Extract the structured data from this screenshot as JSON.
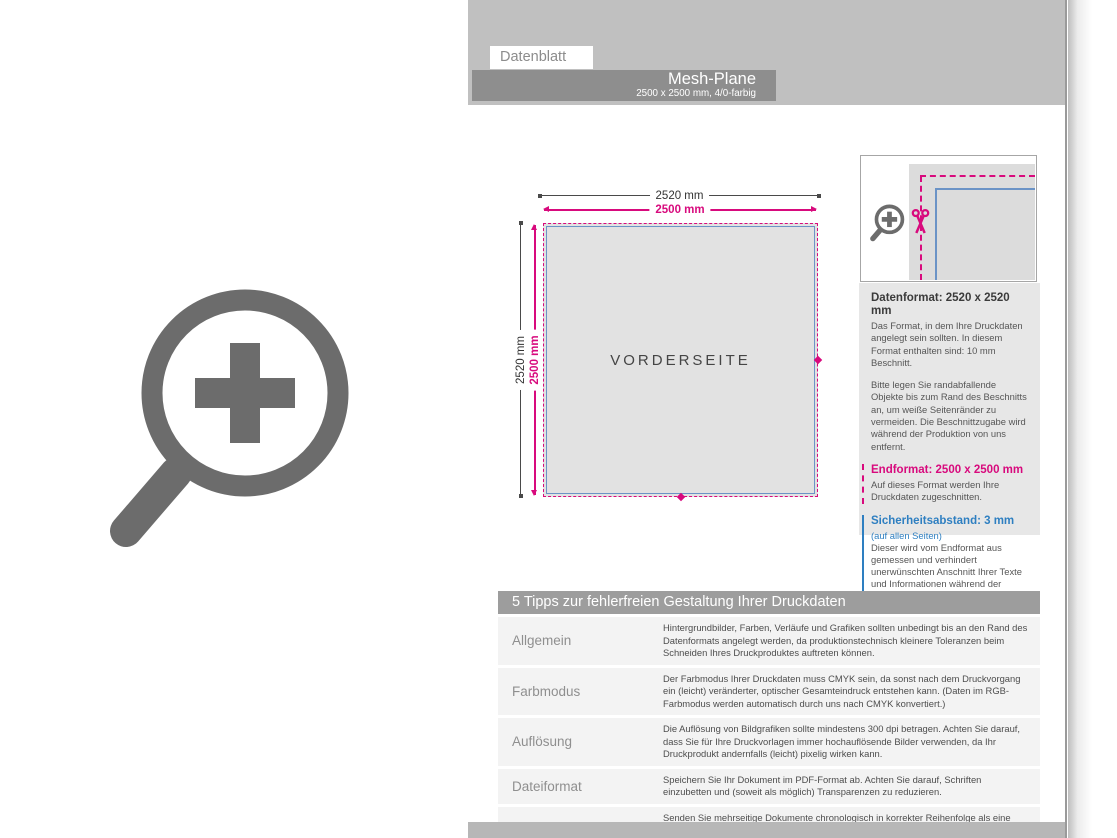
{
  "header": {
    "tab_label": "Datenblatt",
    "product_title": "Mesh-Plane",
    "product_subtitle": "2500 x 2500 mm, 4/0-farbig"
  },
  "left_graphic": {
    "icon": "magnifier-plus"
  },
  "diagram": {
    "width_outer_label": "2520 mm",
    "width_inner_label": "2500 mm",
    "height_outer_label": "2520 mm",
    "height_inner_label": "2500 mm",
    "front_side_label": "VORDERSEITE",
    "detail_icons": {
      "magnifier": "magnifier-plus",
      "cut_marker": "scissors"
    }
  },
  "info_panel": {
    "datenformat": {
      "heading": "Datenformat: 2520 x 2520 mm",
      "paragraph1": "Das Format, in dem Ihre Druckdaten angelegt sein sollten. In diesem Format enthalten sind: 10 mm Beschnitt.",
      "paragraph2": "Bitte legen Sie randabfallende Objekte bis zum Rand des Beschnitts an, um weiße Seitenränder zu vermeiden. Die Beschnittzugabe wird während der Produktion von uns entfernt."
    },
    "endformat": {
      "heading": "Endformat: 2500 x 2500 mm",
      "paragraph1": "Auf dieses Format werden Ihre Druckdaten zugeschnitten."
    },
    "sicherheitsabstand": {
      "heading": "Sicherheitsabstand: 3 mm",
      "subheading": "(auf allen Seiten)",
      "paragraph1": "Dieser wird vom Endformat aus gemessen und verhindert unerwünschten Anschnitt Ihrer Texte und Informationen während der Produktion."
    }
  },
  "tips_table": {
    "header": "5 Tipps zur fehlerfreien Gestaltung Ihrer Druckdaten",
    "rows": [
      {
        "label": "Allgemein",
        "text": "Hintergrundbilder, Farben, Verläufe und Grafiken sollten unbedingt bis an den Rand des Datenformats angelegt werden, da produktionstechnisch kleinere Toleranzen beim Schneiden Ihres Druckproduktes auftreten können."
      },
      {
        "label": "Farbmodus",
        "text": "Der Farbmodus Ihrer Druckdaten muss CMYK sein, da sonst nach dem Druckvorgang ein (leicht) veränderter, optischer Gesamteindruck entstehen kann. (Daten im RGB-Farbmodus werden automatisch durch uns nach CMYK konvertiert.)"
      },
      {
        "label": "Auflösung",
        "text": "Die Auflösung von Bildgrafiken sollte mindestens 300 dpi betragen. Achten Sie darauf, dass Sie für Ihre Druckvorlagen immer hochauflösende Bilder verwenden, da Ihr Druckprodukt andernfalls (leicht) pixelig wirken kann."
      },
      {
        "label": "Dateiformat",
        "text": "Speichern Sie Ihr Dokument im PDF-Format ab. Achten Sie darauf, Schriften einzubetten und (soweit als möglich) Transparenzen zu reduzieren."
      },
      {
        "label": "Seiten(-reihenfolge)",
        "text": "Senden Sie mehrseitige Dokumente chronologisch in korrekter Reihenfolge als eine einzige PDF-Datei oder benennen Sie Einzeldokumente entsprechend mit fortlaufenden Seitennummern."
      }
    ]
  },
  "colors": {
    "magenta": "#d80a7d",
    "blue": "#2e7fc1",
    "square_blue": "#6b93c6",
    "header_band": "#c0c0c0",
    "title_bar": "#8e8e8e",
    "table_header": "#9d9d9d",
    "row_bg": "#f3f3f3",
    "icon_gray": "#6c6c6c",
    "footer_band": "#b7b7b7",
    "panel_bg": "#e7e7e7",
    "square_fill": "#e2e2e2"
  }
}
